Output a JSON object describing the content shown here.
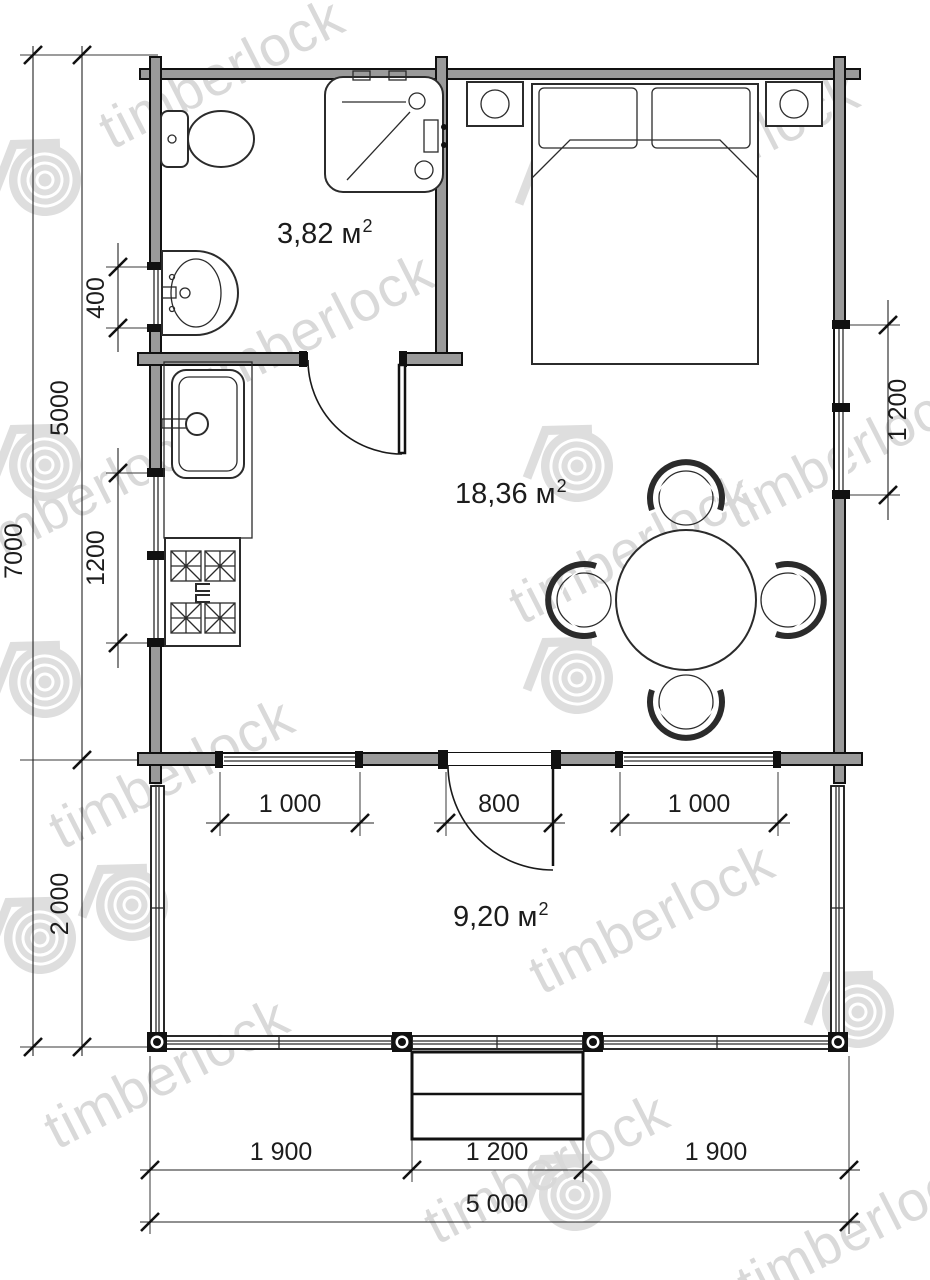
{
  "watermark": {
    "text": "timberlock"
  },
  "rooms": {
    "bathroom": {
      "area": "3,82 м",
      "sup": "2"
    },
    "living": {
      "area": "18,36 м",
      "sup": "2"
    },
    "terrace": {
      "area": "9,20 м",
      "sup": "2"
    }
  },
  "dimensions": {
    "total_height": "7000",
    "main_height": "5000",
    "terrace_height": "2 000",
    "bath_window": "400",
    "kitchen_window": "1200",
    "right_window": "1 200",
    "terrace_window_left": "1 000",
    "terrace_door": "800",
    "terrace_window_right": "1 000",
    "bottom_left": "1 900",
    "bottom_steps": "1 200",
    "bottom_right": "1 900",
    "total_width": "5 000"
  },
  "colors": {
    "line": "#1a1a1a",
    "watermark": "#d9d9d9"
  }
}
